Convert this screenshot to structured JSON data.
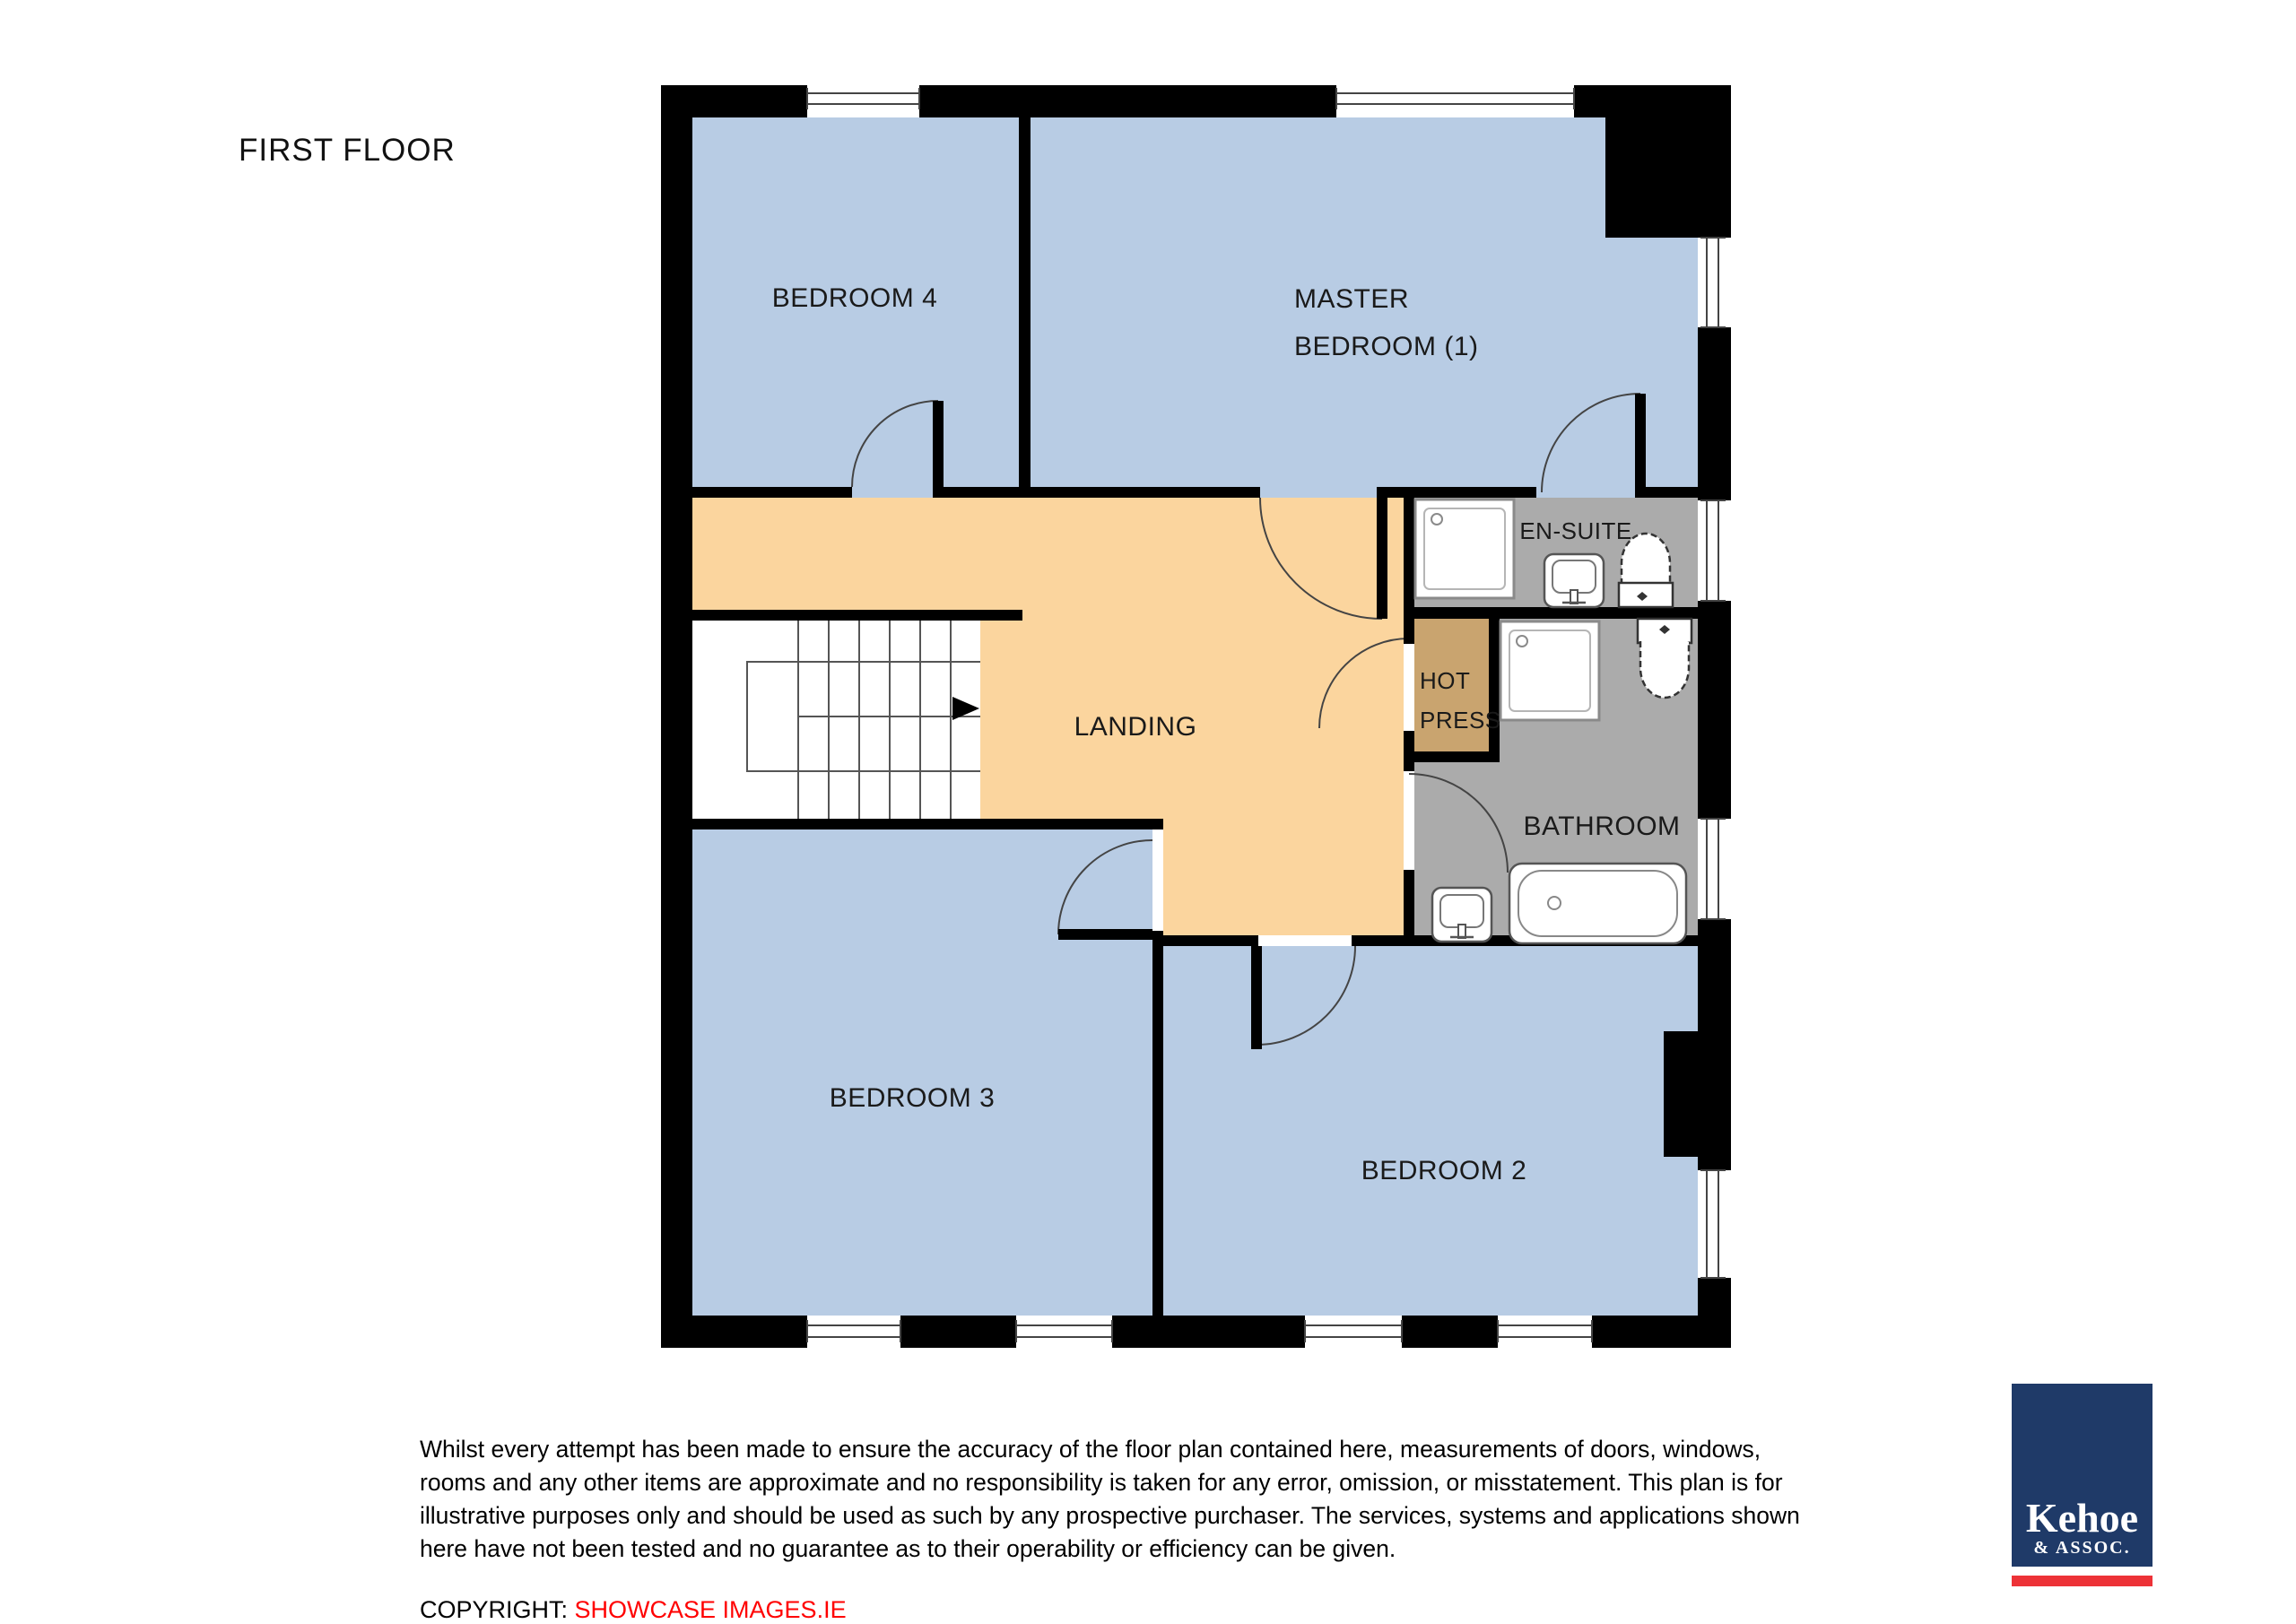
{
  "title": "FIRST FLOOR",
  "plan": {
    "rooms": {
      "bedroom4": "BEDROOM 4",
      "master_line1": "MASTER",
      "master_line2": "BEDROOM (1)",
      "ensuite": "EN-SUITE",
      "hotpress_line1": "HOT",
      "hotpress_line2": "PRESS",
      "landing": "LANDING",
      "bathroom": "BATHROOM",
      "bedroom3": "BEDROOM 3",
      "bedroom2": "BEDROOM 2"
    },
    "colors": {
      "bedroom": "#b8cce4",
      "landing": "#fbd59e",
      "hotpress": "#c9a46f",
      "wetroom": "#ababab",
      "wall": "#000000"
    }
  },
  "disclaimer": {
    "line1": "Whilst every attempt has been made to ensure the accuracy of the floor plan contained here, measurements of doors, windows,",
    "line2": "rooms and any other items are approximate and no responsibility is taken for any error, omission, or misstatement.  This plan is for",
    "line3": "illustrative purposes only and should be used as such by any prospective purchaser.  The services, systems and applications shown",
    "line4": "here have not been tested and no guarantee as to their operability or efficiency can be given."
  },
  "copyright": {
    "label": "COPYRIGHT: ",
    "source": "SHOWCASE IMAGES.IE"
  },
  "logo": {
    "name": "Kehoe",
    "suffix": "& ASSOC.",
    "navy": "#1f3a68",
    "red": "#ed3237"
  }
}
